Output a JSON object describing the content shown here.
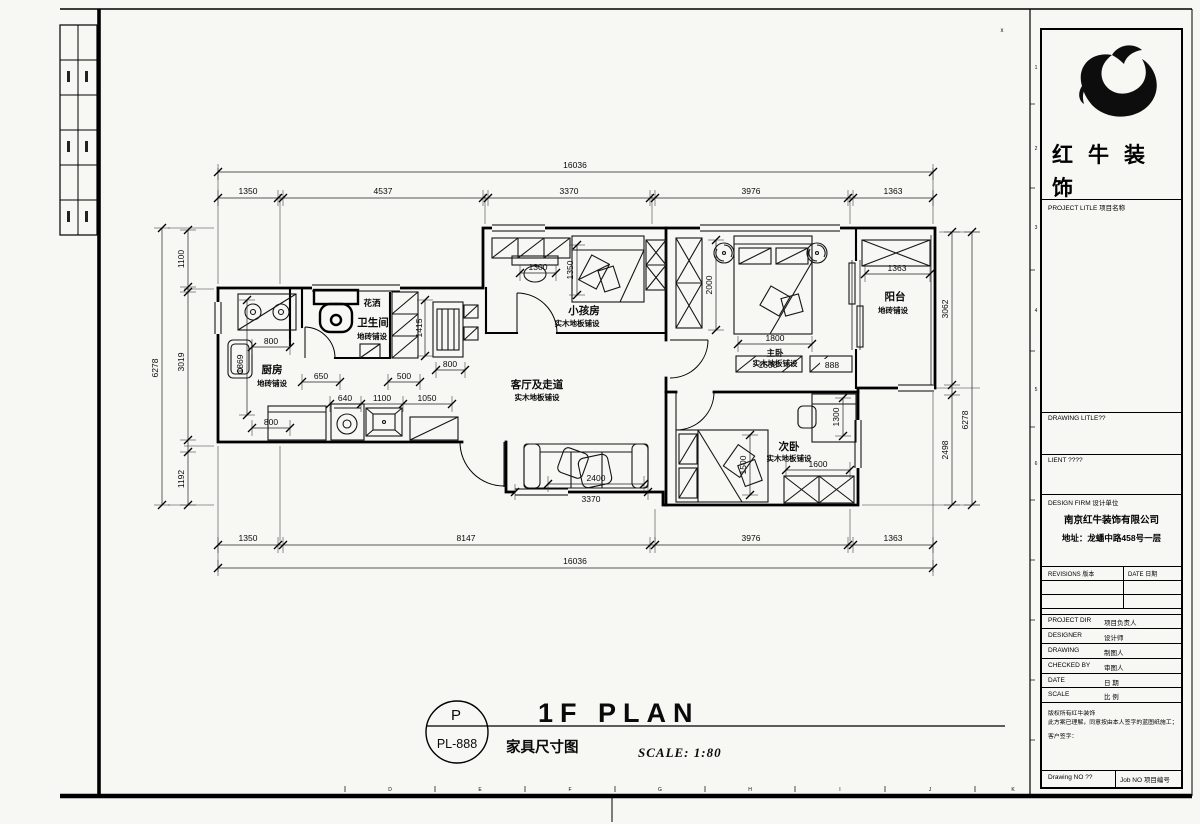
{
  "sheet": {
    "corner_mark": "x",
    "grid_letters": [
      "D",
      "E",
      "F",
      "G",
      "H",
      "I",
      "J",
      "K"
    ],
    "border_numbers": [
      "1",
      "2",
      "3",
      "4",
      "5",
      "6"
    ]
  },
  "plan": {
    "rooms": {
      "kitchen": {
        "name": "厨房",
        "floor": "地砖铺设"
      },
      "bath": {
        "name": "卫生间",
        "floor": "地砖铺设",
        "shower": "花洒"
      },
      "kids": {
        "name": "小孩房",
        "floor": "实木地板铺设"
      },
      "living": {
        "name": "客厅及走道",
        "floor": "实木地板铺设"
      },
      "master": {
        "name": "主卧",
        "floor": "实木地板铺设"
      },
      "balcony": {
        "name": "阳台",
        "floor": "地砖铺设"
      },
      "second": {
        "name": "次卧",
        "floor": "实木地板铺设"
      }
    },
    "dims": {
      "top_total": "16036",
      "top": [
        "1350",
        "4537",
        "3370",
        "3976",
        "1363"
      ],
      "bottom": [
        "1350",
        "8147",
        "3976",
        "1363"
      ],
      "bottom_total": "16036",
      "left_total": "6278",
      "left": [
        "1100",
        "3019",
        "1192"
      ],
      "right": [
        "3062",
        "2498"
      ],
      "right_total": "6278",
      "kitchen": [
        "800",
        "1869",
        "800"
      ],
      "entry": [
        "650",
        "500",
        "1415",
        "800"
      ],
      "counter": [
        "640",
        "1100",
        "1050"
      ],
      "kids": [
        "1300",
        "1350"
      ],
      "master": [
        "2000",
        "1800",
        "1600",
        "888"
      ],
      "balcony": "1363",
      "living": [
        "2400",
        "3370"
      ],
      "second": [
        "1500",
        "1600",
        "1300"
      ]
    }
  },
  "footer": {
    "circle_top": "P",
    "circle_bottom": "PL-888",
    "title": "1F PLAN",
    "subtitle": "家具尺寸图",
    "scale": "SCALE: 1:80"
  },
  "title_block": {
    "brand": "红牛装饰",
    "project_label": "PROJECT LITLE 项目名称",
    "drawing_label": "DRAWING LITLE??",
    "client_label": "LIENT ????",
    "design_firm_label": "DESIGN FIRM 设计单位",
    "firm_name": "南京红牛装饰有限公司",
    "firm_addr": "地址：龙蟠中路458号一层",
    "revisions_label": "REVISIONS 版本",
    "date_label": "DATE 日期",
    "rows": [
      {
        "en": "PROJECT DIR",
        "cn": "项目负责人"
      },
      {
        "en": "DESIGNER",
        "cn": "设计师"
      },
      {
        "en": "DRAWING",
        "cn": "制图人"
      },
      {
        "en": "CHECKED BY",
        "cn": "审图人"
      },
      {
        "en": "DATE",
        "cn": "日 期"
      },
      {
        "en": "SCALE",
        "cn": "比 例"
      }
    ],
    "copyright1": "版权所有红牛装饰",
    "copyright2": "此方案已理解，同意按由本人签字的蓝图纸施工；",
    "signature": "客户签字：",
    "drawing_no": "Drawing NO ??",
    "job_no": "Job NO 项目编号"
  }
}
